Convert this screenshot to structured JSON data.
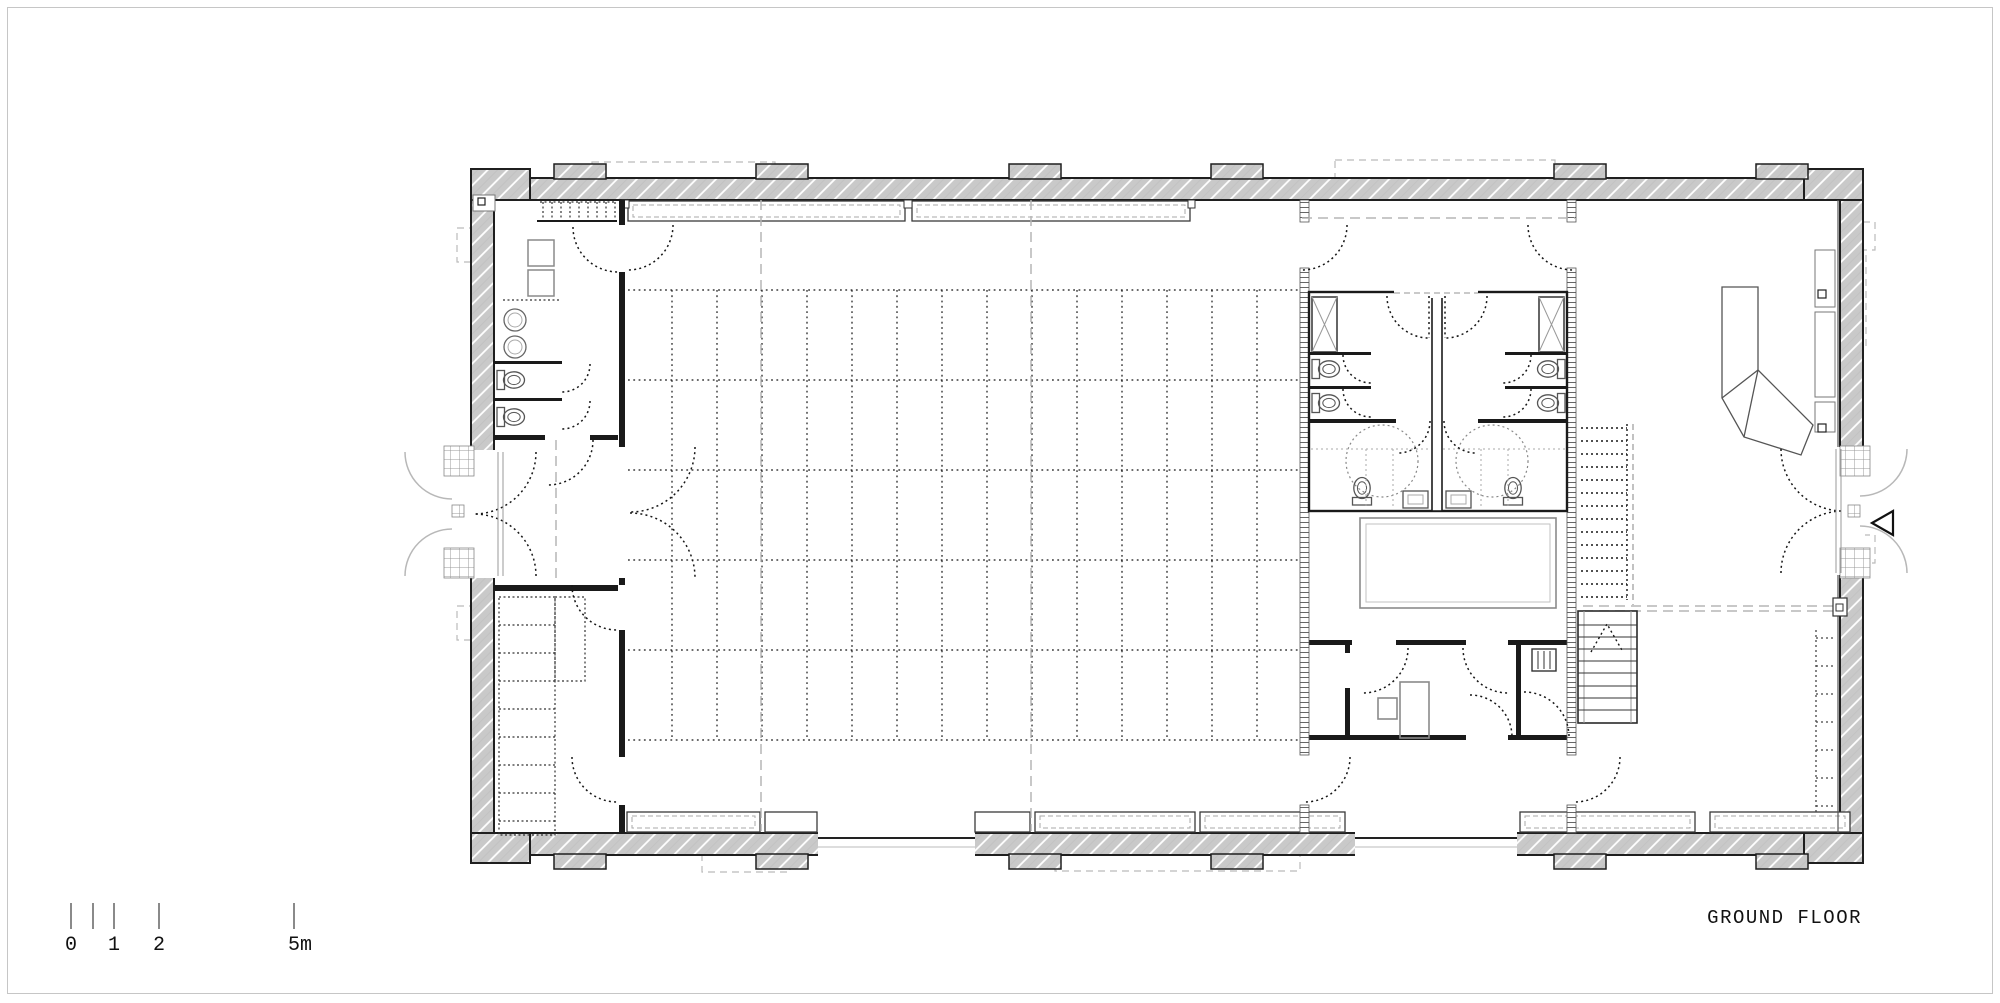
{
  "title": {
    "label": "GROUND FLOOR"
  },
  "scale_bar": {
    "unit": "m",
    "ticks": [
      {
        "label": "0"
      },
      {
        "label": ""
      },
      {
        "label": "1"
      },
      {
        "label": "2"
      },
      {
        "label": "5m"
      }
    ]
  },
  "colors": {
    "paper": "#ffffff",
    "frame_line": "#c6c6c6",
    "wall_fill": "#c9c9c9",
    "wall_hatch": "#ffffff",
    "line_dark": "#1a1a1a",
    "line_mid": "#555555",
    "line_light": "#9b9b9b",
    "dash_light": "#b5b5b5",
    "text": "#111111"
  }
}
